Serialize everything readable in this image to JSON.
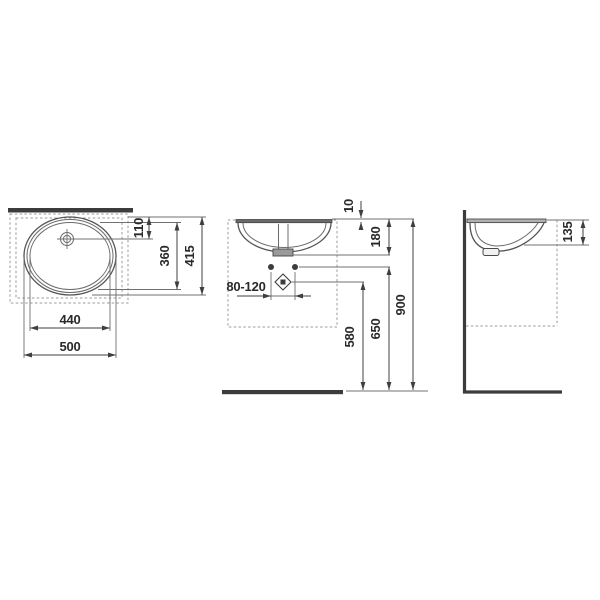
{
  "drawing": {
    "kind": "washbasin installation dimension drawing",
    "colors": {
      "background": "#ffffff",
      "line": "#4f4f4f",
      "heavy_bar": "#3c3c3c",
      "dashed": "#9b9b9b",
      "text": "#2a2a2a"
    },
    "plan": {
      "labels": {
        "d110": "110",
        "d360": "360",
        "d415": "415",
        "d440": "440",
        "d500": "500"
      }
    },
    "front": {
      "labels": {
        "d10": "10",
        "d180": "180",
        "d80_120": "80-120",
        "d580": "580",
        "d650": "650",
        "d900": "900"
      }
    },
    "side": {
      "labels": {
        "d135": "135"
      }
    }
  }
}
